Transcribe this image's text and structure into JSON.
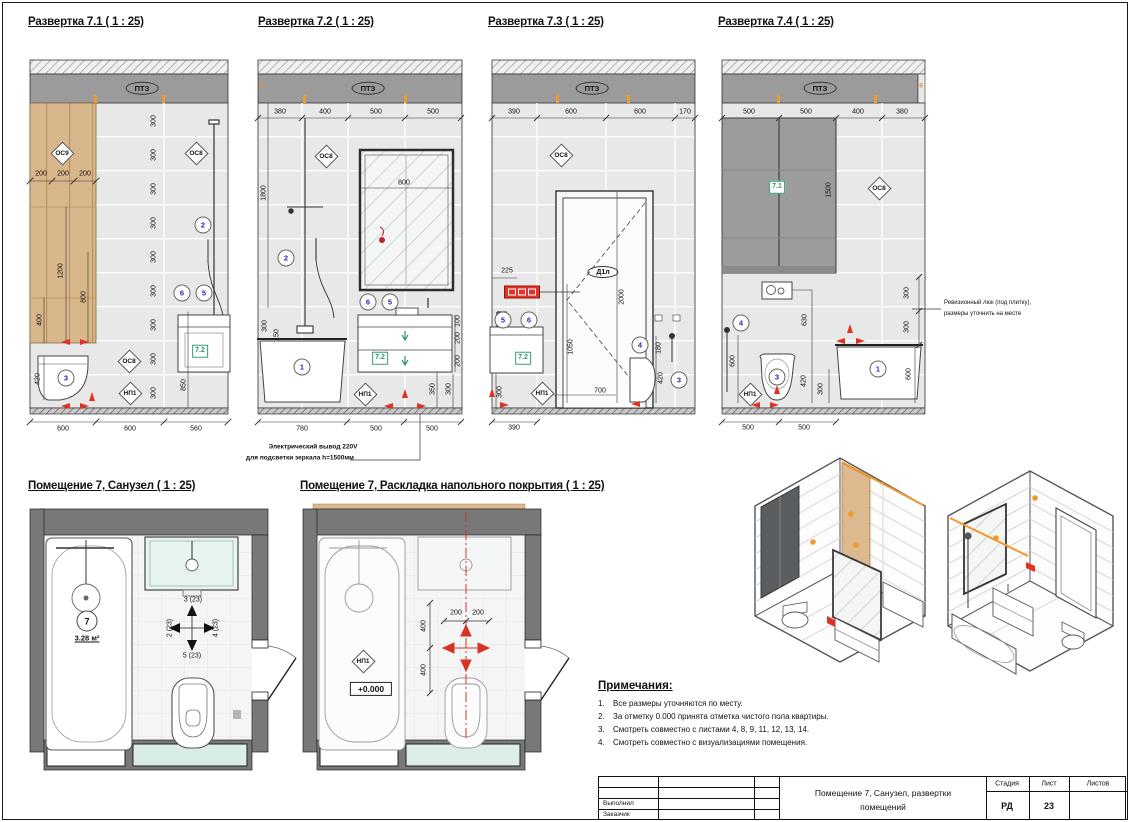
{
  "e1": {
    "title": "Развертка 7.1 ( 1 : 25)",
    "ptz": "ПТЗ",
    "os9": "ОС9",
    "os8a": "ОС8",
    "os8b": "ОС8",
    "np1": "НП1",
    "item": "7.2",
    "c2": "2",
    "c6": "6",
    "c5": "5",
    "c3": "3",
    "t": [
      "200",
      "200",
      "200"
    ],
    "r": [
      "300",
      "300",
      "300",
      "300",
      "300",
      "300",
      "300",
      "300",
      "300"
    ],
    "d1200": "1200",
    "d800": "800",
    "d400": "400",
    "d420": "420",
    "d850": "850",
    "b": [
      "600",
      "600",
      "560"
    ]
  },
  "e2": {
    "title": "Развертка 7.2 ( 1 : 25)",
    "ptz": "ПТЗ",
    "os8": "ОС8",
    "np1": "НП1",
    "item": "7.2",
    "tick": "5",
    "c2": "2",
    "c1": "1",
    "c6": "6",
    "c5": "5",
    "t": [
      "380",
      "400",
      "500",
      "500"
    ],
    "d1800": "1800",
    "d800": "800",
    "d300": "300",
    "d150": "150",
    "v": [
      "100",
      "200",
      "200"
    ],
    "d350": "350",
    "d300b": "300",
    "b": [
      "780",
      "500",
      "500"
    ]
  },
  "e3": {
    "title": "Развертка 7.3 ( 1 : 25)",
    "ptz": "ПТЗ",
    "door": "Д1л",
    "os8": "ОС8",
    "np1": "НП1",
    "item": "7.2",
    "c5": "5",
    "c6": "6",
    "c4": "4",
    "c3": "3",
    "t": [
      "390",
      "600",
      "600",
      "170"
    ],
    "d2000": "2000",
    "d1050": "1050",
    "d700": "700",
    "d225": "225",
    "d300": "300",
    "d390": "390",
    "d420": "420",
    "d180": "180"
  },
  "e4": {
    "title": "Развертка 7.4 ( 1 : 25)",
    "ptz": "ПТЗ",
    "os8": "ОС8",
    "np1": "НП1",
    "item": "7.1",
    "tick": "9",
    "c4": "4",
    "c3": "3",
    "c1": "1",
    "t": [
      "500",
      "500",
      "400",
      "380"
    ],
    "d1500": "1500",
    "d630": "630",
    "d600a": "600",
    "d420": "420",
    "d300a": "300",
    "d600b": "600",
    "r": [
      "300",
      "300"
    ],
    "b": [
      "500",
      "500"
    ]
  },
  "p1": {
    "title": "Помещение 7, Санузел ( 1 : 25)",
    "room": "7",
    "area": "3.28 м²",
    "dir_top": "3 (23)",
    "dir_left": "2 (23)",
    "dir_right": "4 (23)",
    "dir_bottom": "5 (23)"
  },
  "p2": {
    "title": "Помещение 7, Раскладка напольного покрытия ( 1 : 25)",
    "np1": "НП1",
    "level": "+0.000",
    "d200a": "200",
    "d200b": "200",
    "d400a": "400",
    "d400b": "400"
  },
  "ann": {
    "el1": "Электрический вывод 220V",
    "el2": "для подсветки зеркала h=1500мм",
    "rev1": "Ревизионный люк (под плитку),",
    "rev2": "размеры уточнить на месте"
  },
  "notes": {
    "h": "Примечания:",
    "nums": [
      "1.",
      "2.",
      "3.",
      "4."
    ],
    "items": [
      "Все размеры уточняются по месту.",
      "За отметку 0.000 принята отметка чистого пола квартиры.",
      "Смотреть совместно с листами 4, 8, 9, 11, 12, 13, 14.",
      "Смотреть совместно с визуализациями помещения."
    ]
  },
  "tb": {
    "r1": "Выполнил",
    "r2": "Заказчик",
    "title": "Помещение 7, Санузел, развертки",
    "title2": "помещений",
    "stage_l": "Стадия",
    "sheet_l": "Лист",
    "sheets_l": "Листов",
    "stage": "РД",
    "sheet": "23",
    "sheets": ""
  },
  "colors": {
    "wood": "#d9b78c",
    "tile": "#e8e8e8",
    "ceiling": "#9b9b9b",
    "glass_dark": "#9c9c9c",
    "accent_red": "#e03222",
    "accent_orange": "#f09a2e",
    "callout_blue": "#2626b8",
    "item_green": "#2c9a63",
    "wall": "#787878"
  }
}
